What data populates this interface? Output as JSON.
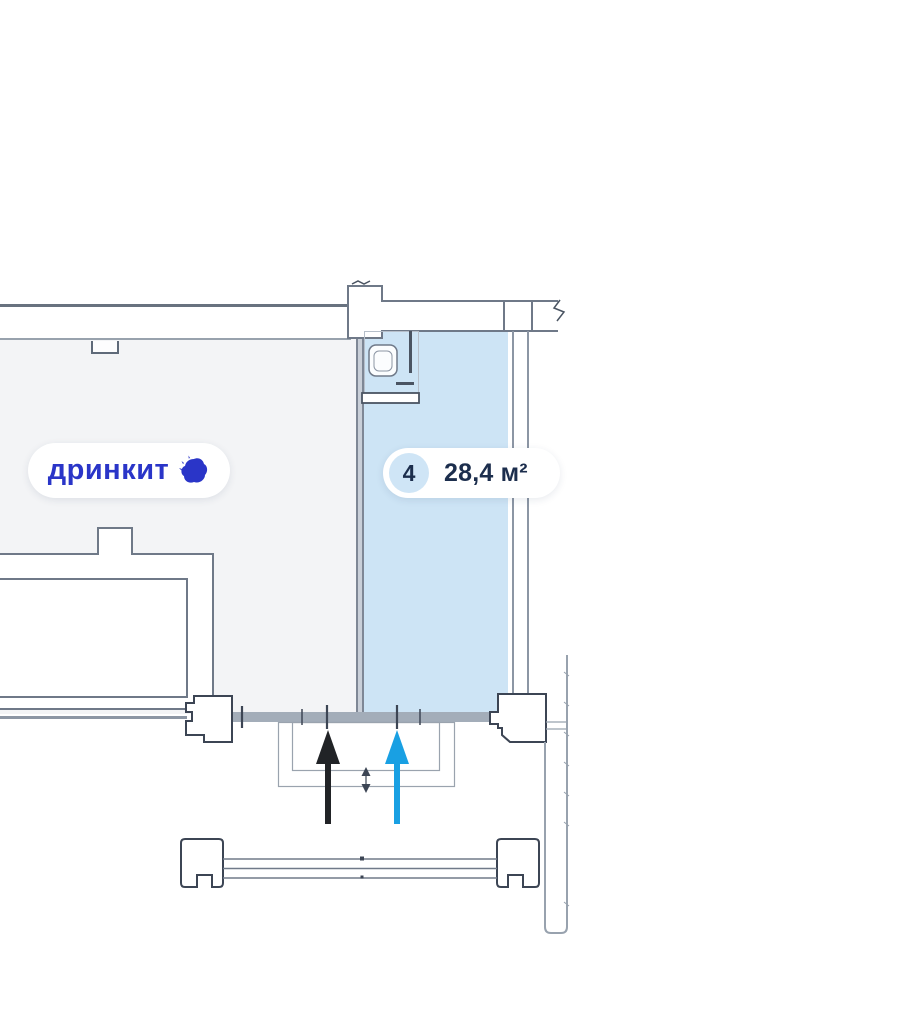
{
  "floor_plan": {
    "tenant_pill": {
      "label": "дринкит",
      "icon_name": "drinkit-splash-logo"
    },
    "unit_badge": {
      "unit_number": "4",
      "area_label": "28,4 м²"
    },
    "colors": {
      "hall_fill": "#f3f4f6",
      "unit_fill": "#cde4f5",
      "tenant_text": "#2a35c8",
      "badge_text": "#1c2e4d",
      "badge_circle_fill": "#cfe5f6",
      "entry_arrow_blue": "#19a0e3",
      "entry_arrow_black": "#212326"
    }
  }
}
